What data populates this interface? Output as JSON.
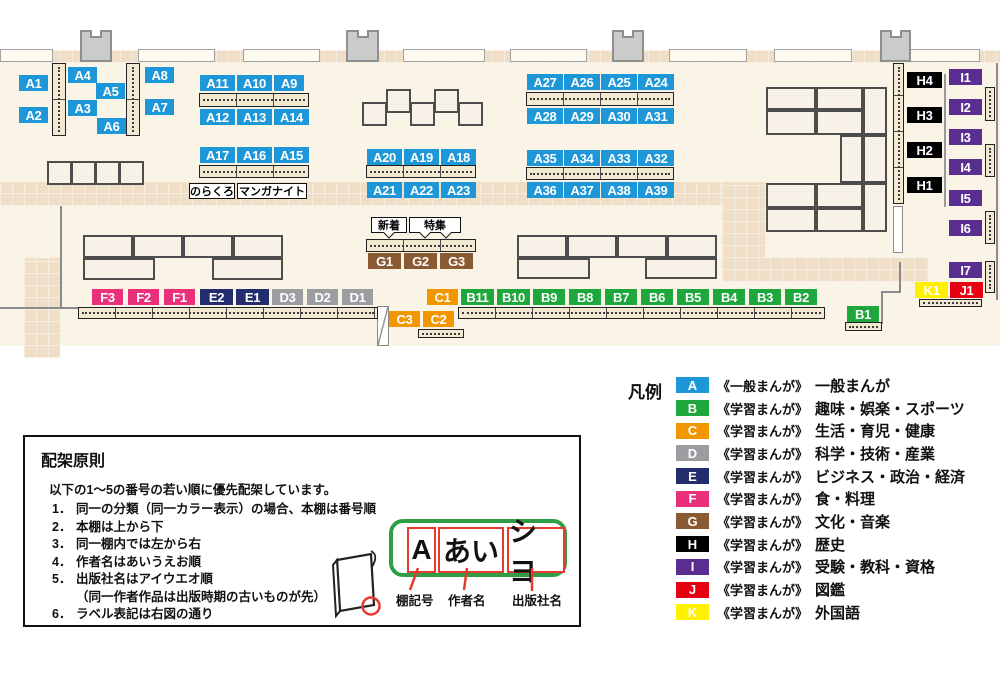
{
  "map": {
    "chips": [
      {
        "t": "A1",
        "x": 19,
        "y": 75,
        "w": 29,
        "cls": "cat-a"
      },
      {
        "t": "A2",
        "x": 19,
        "y": 107,
        "w": 29,
        "cls": "cat-a"
      },
      {
        "t": "A4",
        "x": 68,
        "y": 67,
        "w": 29,
        "cls": "cat-a"
      },
      {
        "t": "A5",
        "x": 96,
        "y": 83,
        "w": 29,
        "cls": "cat-a"
      },
      {
        "t": "A3",
        "x": 68,
        "y": 100,
        "w": 29,
        "cls": "cat-a"
      },
      {
        "t": "A6",
        "x": 97,
        "y": 118,
        "w": 29,
        "cls": "cat-a"
      },
      {
        "t": "A8",
        "x": 145,
        "y": 67,
        "w": 29,
        "cls": "cat-a"
      },
      {
        "t": "A7",
        "x": 145,
        "y": 99,
        "w": 29,
        "cls": "cat-a"
      },
      {
        "t": "A11",
        "x": 200,
        "y": 75,
        "w": 35,
        "cls": "cat-a"
      },
      {
        "t": "A10",
        "x": 237,
        "y": 75,
        "w": 35,
        "cls": "cat-a"
      },
      {
        "t": "A9",
        "x": 274,
        "y": 75,
        "w": 30,
        "cls": "cat-a"
      },
      {
        "t": "A12",
        "x": 200,
        "y": 109,
        "w": 35,
        "cls": "cat-a"
      },
      {
        "t": "A13",
        "x": 237,
        "y": 109,
        "w": 35,
        "cls": "cat-a"
      },
      {
        "t": "A14",
        "x": 274,
        "y": 109,
        "w": 35,
        "cls": "cat-a"
      },
      {
        "t": "A17",
        "x": 200,
        "y": 147,
        "w": 35,
        "cls": "cat-a"
      },
      {
        "t": "A16",
        "x": 237,
        "y": 147,
        "w": 35,
        "cls": "cat-a"
      },
      {
        "t": "A15",
        "x": 274,
        "y": 147,
        "w": 35,
        "cls": "cat-a"
      },
      {
        "t": "A20",
        "x": 367,
        "y": 149,
        "w": 35,
        "cls": "cat-a"
      },
      {
        "t": "A19",
        "x": 404,
        "y": 149,
        "w": 35,
        "cls": "cat-a"
      },
      {
        "t": "A18",
        "x": 441,
        "y": 149,
        "w": 35,
        "cls": "cat-a"
      },
      {
        "t": "A21",
        "x": 367,
        "y": 182,
        "w": 35,
        "cls": "cat-a"
      },
      {
        "t": "A22",
        "x": 404,
        "y": 182,
        "w": 35,
        "cls": "cat-a"
      },
      {
        "t": "A23",
        "x": 441,
        "y": 182,
        "w": 35,
        "cls": "cat-a"
      },
      {
        "t": "A27",
        "x": 527,
        "y": 74,
        "w": 36,
        "cls": "cat-a"
      },
      {
        "t": "A26",
        "x": 564,
        "y": 74,
        "w": 36,
        "cls": "cat-a"
      },
      {
        "t": "A25",
        "x": 601,
        "y": 74,
        "w": 36,
        "cls": "cat-a"
      },
      {
        "t": "A24",
        "x": 638,
        "y": 74,
        "w": 36,
        "cls": "cat-a"
      },
      {
        "t": "A28",
        "x": 527,
        "y": 108,
        "w": 36,
        "cls": "cat-a"
      },
      {
        "t": "A29",
        "x": 564,
        "y": 108,
        "w": 36,
        "cls": "cat-a"
      },
      {
        "t": "A30",
        "x": 601,
        "y": 108,
        "w": 36,
        "cls": "cat-a"
      },
      {
        "t": "A31",
        "x": 638,
        "y": 108,
        "w": 36,
        "cls": "cat-a"
      },
      {
        "t": "A35",
        "x": 527,
        "y": 150,
        "w": 36,
        "cls": "cat-a"
      },
      {
        "t": "A34",
        "x": 564,
        "y": 150,
        "w": 36,
        "cls": "cat-a"
      },
      {
        "t": "A33",
        "x": 601,
        "y": 150,
        "w": 36,
        "cls": "cat-a"
      },
      {
        "t": "A32",
        "x": 638,
        "y": 150,
        "w": 36,
        "cls": "cat-a"
      },
      {
        "t": "A36",
        "x": 527,
        "y": 182,
        "w": 36,
        "cls": "cat-a"
      },
      {
        "t": "A37",
        "x": 564,
        "y": 182,
        "w": 36,
        "cls": "cat-a"
      },
      {
        "t": "A38",
        "x": 601,
        "y": 182,
        "w": 36,
        "cls": "cat-a"
      },
      {
        "t": "A39",
        "x": 638,
        "y": 182,
        "w": 36,
        "cls": "cat-a"
      },
      {
        "t": "G1",
        "x": 368,
        "y": 253,
        "w": 33,
        "cls": "cat-g"
      },
      {
        "t": "G2",
        "x": 404,
        "y": 253,
        "w": 33,
        "cls": "cat-g"
      },
      {
        "t": "G3",
        "x": 440,
        "y": 253,
        "w": 33,
        "cls": "cat-g"
      },
      {
        "t": "H4",
        "x": 907,
        "y": 72,
        "w": 35,
        "cls": "cat-h"
      },
      {
        "t": "H3",
        "x": 907,
        "y": 107,
        "w": 35,
        "cls": "cat-h"
      },
      {
        "t": "H2",
        "x": 907,
        "y": 142,
        "w": 35,
        "cls": "cat-h"
      },
      {
        "t": "H1",
        "x": 907,
        "y": 177,
        "w": 35,
        "cls": "cat-h"
      },
      {
        "t": "I1",
        "x": 949,
        "y": 69,
        "w": 33,
        "cls": "cat-i"
      },
      {
        "t": "I2",
        "x": 949,
        "y": 99,
        "w": 33,
        "cls": "cat-i"
      },
      {
        "t": "I3",
        "x": 949,
        "y": 129,
        "w": 33,
        "cls": "cat-i"
      },
      {
        "t": "I4",
        "x": 949,
        "y": 159,
        "w": 33,
        "cls": "cat-i"
      },
      {
        "t": "I5",
        "x": 949,
        "y": 190,
        "w": 33,
        "cls": "cat-i"
      },
      {
        "t": "I6",
        "x": 949,
        "y": 220,
        "w": 33,
        "cls": "cat-i"
      },
      {
        "t": "I7",
        "x": 949,
        "y": 262,
        "w": 33,
        "cls": "cat-i"
      },
      {
        "t": "K1",
        "x": 915,
        "y": 282,
        "w": 33,
        "cls": "cat-k"
      },
      {
        "t": "J1",
        "x": 950,
        "y": 282,
        "w": 33,
        "cls": "cat-j"
      },
      {
        "t": "F3",
        "x": 92,
        "y": 289,
        "w": 31,
        "cls": "cat-f"
      },
      {
        "t": "F2",
        "x": 128,
        "y": 289,
        "w": 31,
        "cls": "cat-f"
      },
      {
        "t": "F1",
        "x": 164,
        "y": 289,
        "w": 31,
        "cls": "cat-f"
      },
      {
        "t": "E2",
        "x": 200,
        "y": 289,
        "w": 33,
        "cls": "cat-e"
      },
      {
        "t": "E1",
        "x": 236,
        "y": 289,
        "w": 33,
        "cls": "cat-e"
      },
      {
        "t": "D3",
        "x": 272,
        "y": 289,
        "w": 31,
        "cls": "cat-d"
      },
      {
        "t": "D2",
        "x": 307,
        "y": 289,
        "w": 31,
        "cls": "cat-d"
      },
      {
        "t": "D1",
        "x": 342,
        "y": 289,
        "w": 31,
        "cls": "cat-d"
      },
      {
        "t": "C1",
        "x": 427,
        "y": 289,
        "w": 31,
        "cls": "cat-c"
      },
      {
        "t": "C3",
        "x": 389,
        "y": 311,
        "w": 31,
        "cls": "cat-c"
      },
      {
        "t": "C2",
        "x": 423,
        "y": 311,
        "w": 31,
        "cls": "cat-c"
      },
      {
        "t": "B11",
        "x": 461,
        "y": 289,
        "w": 33,
        "cls": "cat-b"
      },
      {
        "t": "B10",
        "x": 497,
        "y": 289,
        "w": 33,
        "cls": "cat-b"
      },
      {
        "t": "B9",
        "x": 533,
        "y": 289,
        "w": 32,
        "cls": "cat-b"
      },
      {
        "t": "B8",
        "x": 569,
        "y": 289,
        "w": 32,
        "cls": "cat-b"
      },
      {
        "t": "B7",
        "x": 605,
        "y": 289,
        "w": 32,
        "cls": "cat-b"
      },
      {
        "t": "B6",
        "x": 641,
        "y": 289,
        "w": 32,
        "cls": "cat-b"
      },
      {
        "t": "B5",
        "x": 677,
        "y": 289,
        "w": 32,
        "cls": "cat-b"
      },
      {
        "t": "B4",
        "x": 713,
        "y": 289,
        "w": 32,
        "cls": "cat-b"
      },
      {
        "t": "B3",
        "x": 749,
        "y": 289,
        "w": 32,
        "cls": "cat-b"
      },
      {
        "t": "B2",
        "x": 785,
        "y": 289,
        "w": 32,
        "cls": "cat-b"
      },
      {
        "t": "B1",
        "x": 847,
        "y": 306,
        "w": 32,
        "cls": "cat-b"
      }
    ],
    "annotations": [
      {
        "t": "のらくろ",
        "x": 189,
        "y": 183,
        "w": 46,
        "cls": "plain"
      },
      {
        "t": "マンガナイト",
        "x": 237,
        "y": 183,
        "w": 70,
        "cls": "plain"
      },
      {
        "t": "新着",
        "x": 371,
        "y": 217,
        "w": 36,
        "cls": "tail1"
      },
      {
        "t": "特集",
        "x": 409,
        "y": 217,
        "w": 52,
        "cls": "tail2"
      }
    ]
  },
  "legend": {
    "title": "凡例",
    "items": [
      {
        "code": "A",
        "cls": "cat-a",
        "color": "#1e97d9",
        "series": "《一般まんが》",
        "label": "一般まんが"
      },
      {
        "code": "B",
        "cls": "cat-b",
        "color": "#1ea73c",
        "series": "《学習まんが》",
        "label": "趣味・娯楽・スポーツ"
      },
      {
        "code": "C",
        "cls": "cat-c",
        "color": "#f29600",
        "series": "《学習まんが》",
        "label": "生活・育児・健康"
      },
      {
        "code": "D",
        "cls": "cat-d",
        "color": "#9c9da0",
        "series": "《学習まんが》",
        "label": "科学・技術・産業"
      },
      {
        "code": "E",
        "cls": "cat-e",
        "color": "#232d6d",
        "series": "《学習まんが》",
        "label": "ビジネス・政治・経済"
      },
      {
        "code": "F",
        "cls": "cat-f",
        "color": "#ea2f7b",
        "series": "《学習まんが》",
        "label": "食・料理"
      },
      {
        "code": "G",
        "cls": "cat-g",
        "color": "#8a5b33",
        "series": "《学習まんが》",
        "label": "文化・音楽"
      },
      {
        "code": "H",
        "cls": "cat-h",
        "color": "#000000",
        "series": "《学習まんが》",
        "label": "歴史"
      },
      {
        "code": "I",
        "cls": "cat-i",
        "color": "#5a2d90",
        "series": "《学習まんが》",
        "label": "受験・教科・資格"
      },
      {
        "code": "J",
        "cls": "cat-j",
        "color": "#e60012",
        "series": "《学習まんが》",
        "label": "図鑑"
      },
      {
        "code": "K",
        "cls": "cat-k",
        "color": "#ffef00",
        "series": "《学習まんが》",
        "label": "外国語"
      }
    ]
  },
  "principles": {
    "title": "配架原則",
    "intro": "以下の1～5の番号の若い順に優先配架しています。",
    "items": [
      {
        "n": "1．",
        "t": "同一の分類（同一カラー表示）の場合、本棚は番号順"
      },
      {
        "n": "2．",
        "t": "本棚は上から下"
      },
      {
        "n": "3．",
        "t": "同一棚内では左から右"
      },
      {
        "n": "4．",
        "t": "作者名はあいうえお順"
      },
      {
        "n": "5．",
        "t": "出版社名はアイウエオ順",
        "note": "（同一作者作品は出版時期の古いものが先）"
      },
      {
        "n": "6．",
        "t": "ラベル表記は右図の通り"
      }
    ],
    "label_example": {
      "shelf_code": "A",
      "author": "あい",
      "publisher": "シヨ"
    },
    "label_captions": {
      "shelf_code": "棚記号",
      "author": "作者名",
      "publisher": "出版社名"
    }
  }
}
